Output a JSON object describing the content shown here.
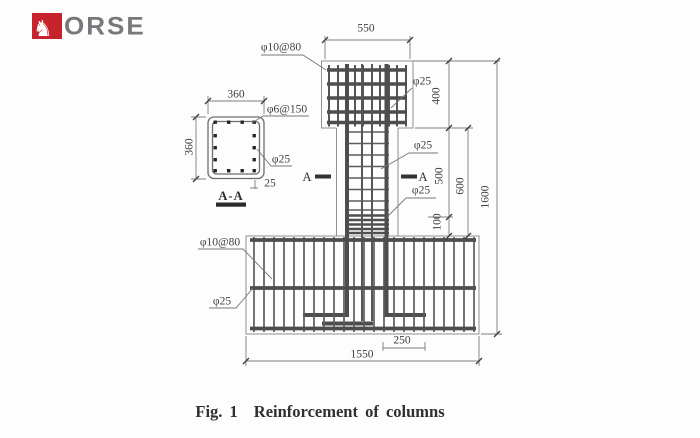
{
  "logo": {
    "horse_icon": "♞",
    "letters": "ORSE"
  },
  "colors": {
    "logo_red": "#c6232d",
    "logo_gray": "#77787b",
    "line_dark": "#4d4d4d"
  },
  "labels": {
    "dim_550": "550",
    "dim_400": "400",
    "dim_500": "500",
    "dim_600": "600",
    "dim_100": "100",
    "dim_1600": "1600",
    "dim_1550": "1550",
    "dim_250": "250",
    "dim_360_top": "360",
    "dim_360_left": "360",
    "dim_25_cover": "25",
    "head_stirrup": "φ10@80",
    "head_bar": "φ25",
    "column_bar_upper": "φ25",
    "column_bar_lower": "φ25",
    "section_stirrup": "φ6@150",
    "section_bar": "φ25",
    "section_title": "A-A",
    "section_marker_left": "A",
    "section_marker_right": "A",
    "footing_stirrup": "φ10@80",
    "footing_bar": "φ25"
  },
  "figure": {
    "caption_label": "Fig. 1",
    "caption_title": "Reinforcement of columns"
  }
}
